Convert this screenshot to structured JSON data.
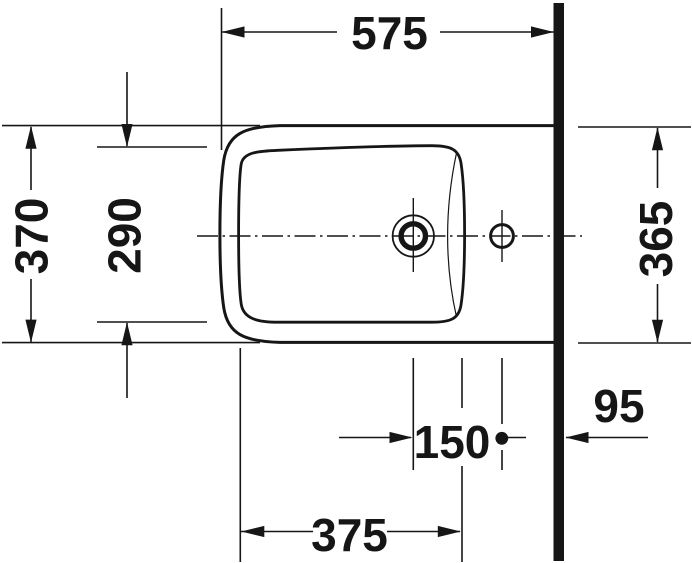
{
  "drawing": {
    "title": "Bidet plan view installation drawing",
    "view": "top view with wall at right",
    "colors": {
      "line": "#161616",
      "background": "#ffffff"
    },
    "dimensions": {
      "top": "575",
      "left_outer": "370",
      "left_inner": "290",
      "right": "365",
      "holes_spacing": "150",
      "wall_offset": "95",
      "bottom_span": "375"
    }
  }
}
